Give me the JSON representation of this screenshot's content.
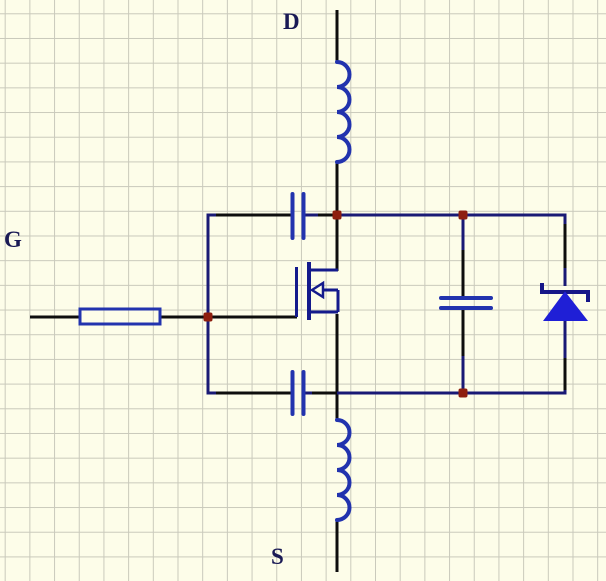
{
  "window": {
    "type": "schematic-editor-canvas",
    "width_px": 606,
    "height_px": 581
  },
  "canvas": {
    "background": "#FDFDE9",
    "grid_line": "#C9C9BB",
    "grid_size_px": 24.7
  },
  "palette": {
    "wire_black": "#0D0D0D",
    "wire_navy": "#191975",
    "component_blue": "#2233AE",
    "mosfet_blue": "#141A8C",
    "diode_navy": "#161688",
    "diode_fill": "#1F1FD6",
    "junction_red": "#8E1E0F",
    "label_color": "#1A1A55"
  },
  "terminals": {
    "drain": "D",
    "gate": "G",
    "source": "S"
  },
  "components": [
    {
      "name": "drain-inductor",
      "type": "inductor",
      "orientation": "vertical",
      "turns": 4
    },
    {
      "name": "source-inductor",
      "type": "inductor",
      "orientation": "vertical",
      "turns": 4
    },
    {
      "name": "gate-resistor",
      "type": "resistor",
      "orientation": "horizontal"
    },
    {
      "name": "gate-drain-capacitor",
      "type": "capacitor",
      "orientation": "horizontal"
    },
    {
      "name": "gate-source-capacitor",
      "type": "capacitor",
      "orientation": "horizontal"
    },
    {
      "name": "drain-source-capacitor",
      "type": "capacitor",
      "orientation": "vertical"
    },
    {
      "name": "body-diode",
      "type": "schottky-diode",
      "orientation": "vertical",
      "anode": "bottom",
      "cathode": "top"
    },
    {
      "name": "mosfet",
      "type": "n-channel-mosfet",
      "arrow": "left"
    }
  ],
  "junction_dots": 4
}
